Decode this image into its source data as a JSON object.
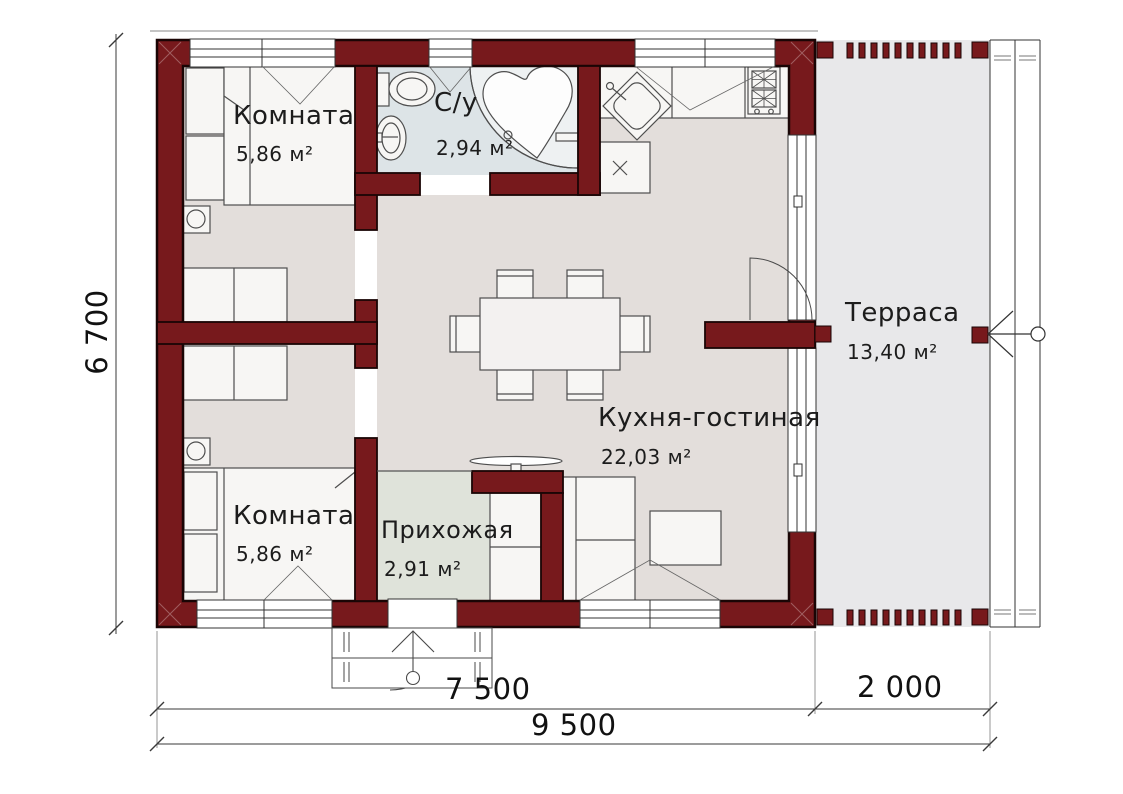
{
  "drawing": {
    "type": "floor-plan",
    "rooms": [
      {
        "id": "bedroom-top",
        "name": "Комната",
        "area": "5,86 м²"
      },
      {
        "id": "bathroom",
        "name": "С/у",
        "area": "2,94 м²"
      },
      {
        "id": "kitchen-living",
        "name": "Кухня-гостиная",
        "area": "22,03 м²"
      },
      {
        "id": "bedroom-bottom",
        "name": "Комната",
        "area": "5,86 м²"
      },
      {
        "id": "hallway",
        "name": "Прихожая",
        "area": "2,91 м²"
      },
      {
        "id": "terrace",
        "name": "Терраса",
        "area": "13,40 м²"
      }
    ],
    "dimensions": {
      "left_total": "6 700",
      "bottom_house": "7 500",
      "bottom_terrace": "2 000",
      "bottom_total": "9 500"
    },
    "colors": {
      "wall": "#77191c",
      "wall_outline": "#1a0505",
      "floor_main": "#e3dedb",
      "floor_bathroom": "#dde4e7",
      "floor_hallway": "#dfe3da",
      "floor_terrace": "#e8e8ea",
      "furniture_fill": "#f7f6f4",
      "line": "#454545"
    }
  }
}
